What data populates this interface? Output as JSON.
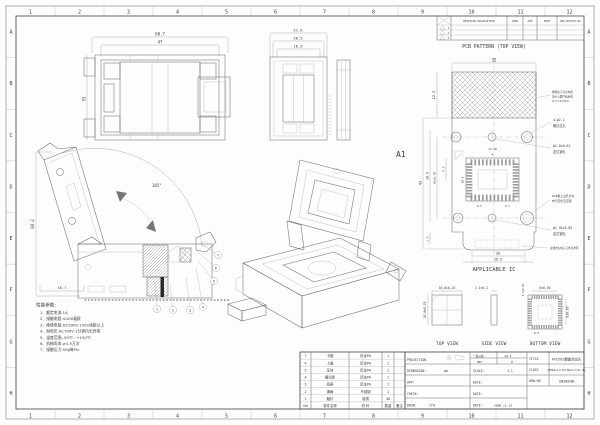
{
  "sheet": {
    "zones": {
      "cols": [
        "1",
        "2",
        "3",
        "4",
        "5",
        "6",
        "7",
        "8",
        "9",
        "10",
        "11",
        "12"
      ],
      "rows": [
        "A",
        "B",
        "C",
        "D",
        "E",
        "F",
        "G",
        "H"
      ]
    }
  },
  "revision_table": {
    "headers": [
      "REVISION DESCRIPTION",
      "CHKD",
      "APP",
      "DATE",
      "REV.NOTICE.NO"
    ],
    "rows": [
      {
        "flag": "1"
      },
      {
        "flag": "2"
      },
      {
        "flag": "3"
      }
    ]
  },
  "views": {
    "front": {
      "dim_w_outer": "60.7",
      "dim_w_inner": "47",
      "dim_h": "53"
    },
    "side": {
      "dim_w1": "21.6",
      "dim_w2": "20.5",
      "dim_w3": "16.5"
    },
    "section": {
      "dim_h": "98.2",
      "dim_angle": "105°",
      "dim_offset": "16.7",
      "balloons": [
        "1",
        "2",
        "3",
        "4",
        "5",
        "6",
        "7"
      ]
    },
    "iso": {
      "label": "A1"
    }
  },
  "pcb_pattern": {
    "title": "PCB PATTERN (TOP VIEW)",
    "dim_w": "32",
    "dim_hatch_h": "12.5",
    "dim_h": "43",
    "dim_span_v": "30.9",
    "dim_span": "30±0.02",
    "dim_55": "5.5",
    "dim_15": "1.5",
    "dim_20": "20",
    "dim_265": "26.5",
    "fp_w": "13.18",
    "fp_4": "4",
    "fp_h": "10.8",
    "fp_p1": "0.5",
    "fp_p2": "0.3",
    "notes": {
      "keepout": [
        "网纹处下方可布置",
        "电子元器件和走线",
        "0<T<0.5mm"
      ],
      "screw": [
        "4-φ2.2",
        "螺丝过孔"
      ],
      "locating1": [
        "φ2.0±0.02",
        "定位销孔"
      ],
      "via": [
        "PCB板上过孔允许",
        "布于定位孔范围"
      ],
      "locating2": [
        "φ1.95+0.05",
        "定位销孔"
      ],
      "forbidden": "虚线内为电子元件禁布区"
    }
  },
  "applicable_ic": {
    "label": "APPLICABLE IC",
    "top": {
      "label": "TOP VIEW",
      "dim_w": "10.8±0.25",
      "dim_h": "10.8±0.25"
    },
    "side": {
      "label": "SIDE VIEW",
      "dim_t": "2.1±0.2"
    },
    "bottom": {
      "label": "BOTTOM VIEW",
      "dim_w": "6±0.05",
      "dim_h": "6±0.05",
      "dim_pad": "0.3±0.05",
      "dim_pitch": "0.5"
    }
  },
  "performance": {
    "title": "性能参数:",
    "lines": [
      "1、额定电流:1A",
      "2、接触电阻:≤100毫欧",
      "3、绝缘电阻:DC500V 1000兆欧以上",
      "4、耐电压:AC700V 1分钟内无异常",
      "5、温度范围:-50℃~+150℃",
      "6、机械寿命:≥1.5万次",
      "7、接触压力:50g每Pin"
    ]
  },
  "parts_table": {
    "headers": [
      "No",
      "零件名称",
      "材 料",
      "数量",
      "备注"
    ],
    "rows": [
      {
        "no": "7",
        "name": "卡圈",
        "material": "尼龙PA",
        "qty": "1",
        "remark": ""
      },
      {
        "no": "6",
        "name": "上盖",
        "material": "尼龙PA",
        "qty": "1",
        "remark": ""
      },
      {
        "no": "5",
        "name": "压块",
        "material": "尼龙PA",
        "qty": "1",
        "remark": ""
      },
      {
        "no": "4",
        "name": "摆动架",
        "material": "尼龙PA",
        "qty": "1",
        "remark": ""
      },
      {
        "no": "3",
        "name": "底座",
        "material": "尼龙PA",
        "qty": "1",
        "remark": ""
      },
      {
        "no": "2",
        "name": "弹簧",
        "material": "不锈钢",
        "qty": "1",
        "remark": ""
      },
      {
        "no": "1",
        "name": "触针",
        "material": "铍铜",
        "qty": "48",
        "remark": ""
      }
    ]
  },
  "title_block": {
    "projection_label": "PROJECTION",
    "dimension_label": "DIMENSION:",
    "dimension_value": "mm",
    "app_label": "APP:",
    "check_label": "CHECK:",
    "drgn_label": "DRGN:",
    "drgn_value": "CYQ",
    "tolerance_label": "一般公差",
    "tolerance_value": "±0.1",
    "rev_label": "REV",
    "rev_value": "A",
    "scale_label": "SCALE:",
    "scale_value": "1:1",
    "date_label": "DATE:",
    "date_value": "2008.11.12",
    "title_label": "TITLE",
    "title_value": "FP2502翻盖测试头",
    "class_label": "CLASS",
    "class_value": "CQFN48-0.8-STO-BGA(0.5X11.7B)",
    "drwno_label": "DRW.NO",
    "drwno_value": "SN28D48"
  }
}
